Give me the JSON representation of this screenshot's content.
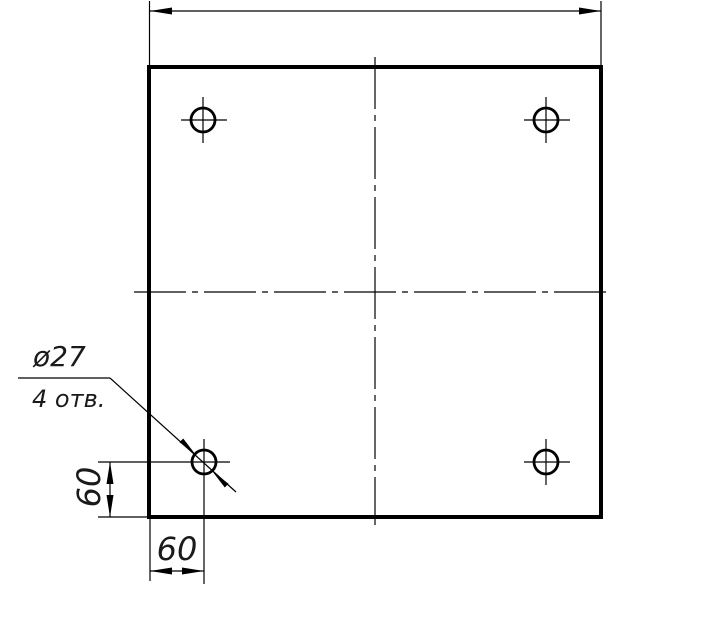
{
  "drawing": {
    "kind": "technical-drawing-plate-with-holes",
    "callout": {
      "line1": "ø27",
      "line2": "4 отв."
    },
    "dimensions": {
      "left_vertical": "60",
      "bottom_horizontal": "60"
    },
    "colors": {
      "line": "#000000",
      "background": "#ffffff"
    }
  }
}
